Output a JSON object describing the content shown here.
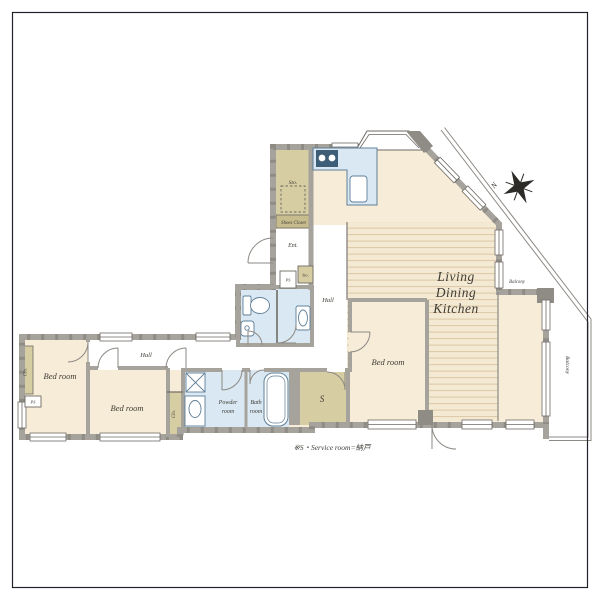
{
  "title": "apartment-floor-plan",
  "colors": {
    "room_beige": "#f6ecd7",
    "stripe_line": "#dbc8a5",
    "olive": "#d6cda2",
    "olive_dark": "#c6bc8d",
    "water_blue": "#d9e8f2",
    "wall_gray": "#a6a29c",
    "wall_dark": "#6e6a64",
    "text": "#3f3b35",
    "frame": "#23222b"
  },
  "rooms": {
    "bedroom1": "Bed room",
    "bedroom2": "Bed room",
    "bedroom3": "Bed room",
    "ldk_line1": "Living",
    "ldk_line2": "Dining",
    "ldk_line3": "Kitchen",
    "hall_upper": "Hall",
    "hall_lower": "Hall",
    "entrance": "Ent.",
    "storage_room": "Sto.",
    "storage_small": "Sto.",
    "shoes_closet": "Shoes Closet",
    "ps_entrance": "PS",
    "ps_left": "PS",
    "closet_left": "Clo.",
    "closet_right": "Clo.",
    "powder_line1": "Powder",
    "powder_line2": "room",
    "bath_line1": "Bath",
    "bath_line2": "room",
    "service": "S",
    "balcony_upper": "Balcony",
    "balcony_right": "Balcony"
  },
  "compass": {
    "north": "N"
  },
  "footnote": "※S・Service room=納戸"
}
